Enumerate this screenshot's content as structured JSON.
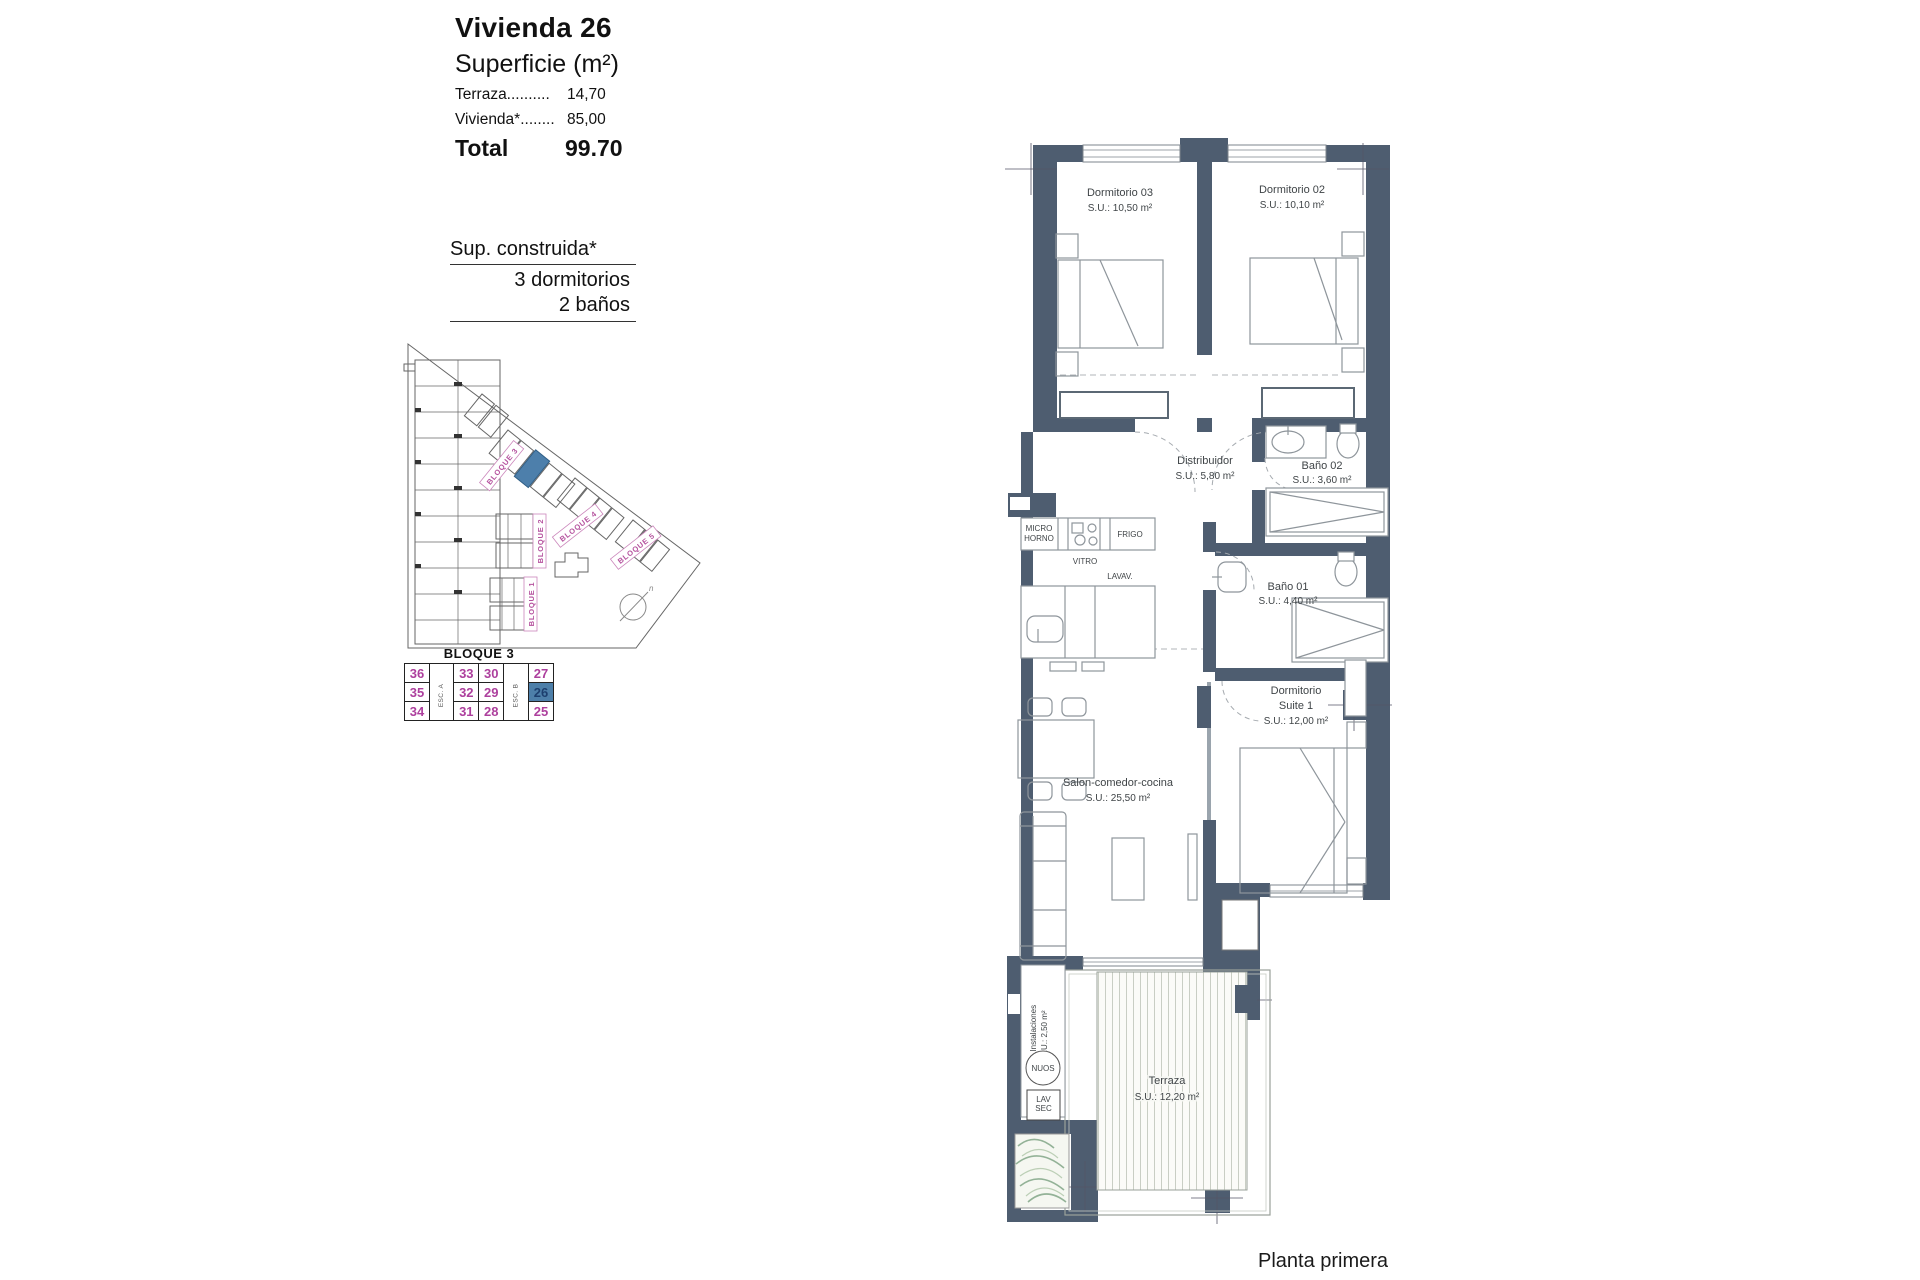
{
  "page": {
    "caption": "Planta primera"
  },
  "title_block": {
    "title": "Vivienda 26",
    "subtitle": "Superficie (m²)",
    "rows": [
      {
        "label": "Terraza..........",
        "value": "14,70"
      },
      {
        "label": "Vivienda*........",
        "value": "85,00"
      }
    ],
    "total_label": "Total",
    "total_value": "99.70"
  },
  "summary": {
    "line1": "Sup. construida*",
    "line2": "3 dormitorios",
    "line3": "2 baños"
  },
  "site_plan": {
    "labels": {
      "b1": "BLOQUE 1",
      "b2": "BLOQUE 2",
      "b3": "BLOQUE 3",
      "b4": "BLOQUE 4",
      "b5": "BLOQUE 5"
    },
    "compass_n": "n",
    "highlight_color": "#4d7fab",
    "label_color": "#b5519e"
  },
  "unit_table": {
    "title": "BLOQUE 3",
    "esc_a": "ESC. A",
    "esc_b": "ESC. B",
    "rows": [
      [
        "36",
        "33",
        "30",
        "27"
      ],
      [
        "35",
        "32",
        "29",
        "26"
      ],
      [
        "34",
        "31",
        "28",
        "25"
      ]
    ],
    "highlighted_unit": "26",
    "highlight_color": "#4d7fa9"
  },
  "floor_plan": {
    "rooms": {
      "dorm03": {
        "name": "Dormitorio 03",
        "area": "S.U.: 10,50 m²"
      },
      "dorm02": {
        "name": "Dormitorio 02",
        "area": "S.U.: 10,10 m²"
      },
      "distribuidor": {
        "name": "Distribuidor",
        "area": "S.U.: 5,80 m²"
      },
      "bano02": {
        "name": "Baño 02",
        "area": "S.U.: 3,60 m²"
      },
      "bano01": {
        "name": "Baño 01",
        "area": "S.U.: 4,40 m²"
      },
      "suite": {
        "name_line1": "Dormitorio",
        "name_line2": "Suite 1",
        "area": "S.U.: 12,00 m²"
      },
      "salon": {
        "name": "Salon-comedor-cocina",
        "area": "S.U.: 25,50 m²"
      },
      "terraza": {
        "name": "Terraza",
        "area": "S.U.: 12,20 m²"
      },
      "instalaciones": {
        "name": "A.Instalaciones",
        "area": "S.U.: 2,50 m²"
      }
    },
    "fixtures": {
      "micro1": "MICRO",
      "micro2": "HORNO",
      "vitro": "VITRO",
      "frigo": "FRIGO",
      "lavav": "LAVAV.",
      "nuos": "NUOS",
      "lavsec1": "LAV",
      "lavsec2": "SEC"
    },
    "wall_color": "#4e5d70"
  }
}
